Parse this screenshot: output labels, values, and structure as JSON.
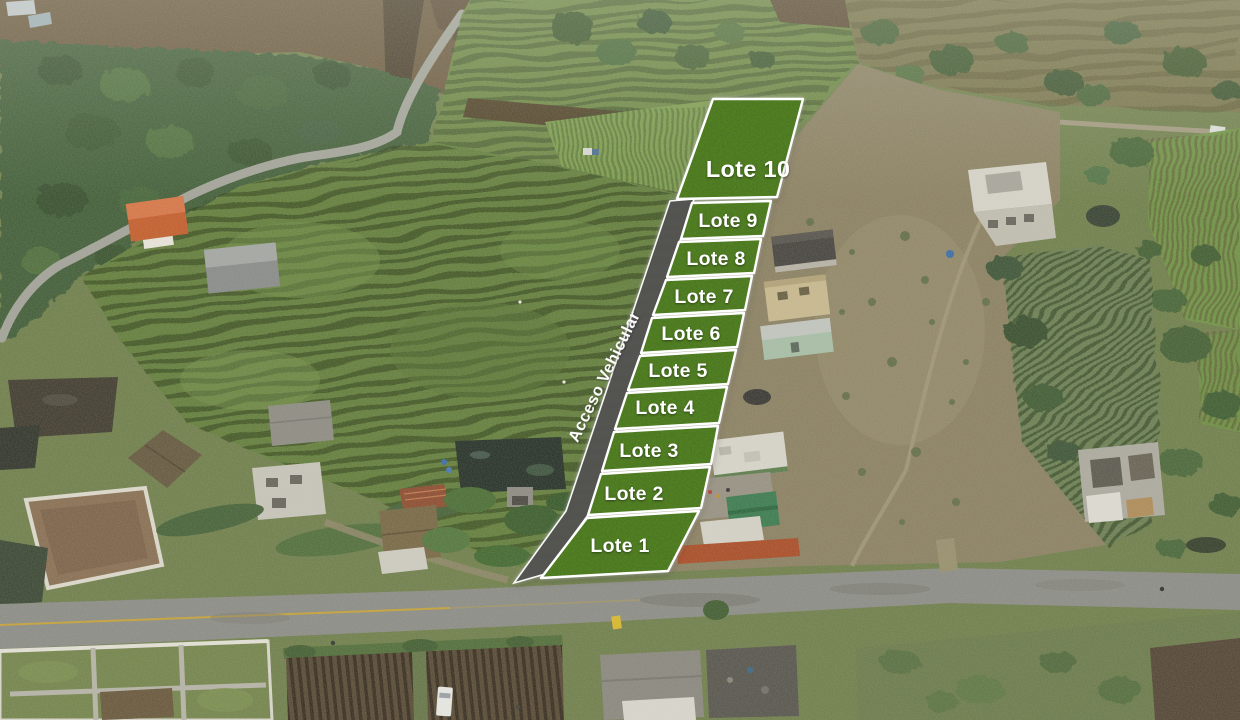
{
  "overlay": {
    "access_road_label": "Acceso Vehicular",
    "lots": [
      {
        "label": "Lote 1"
      },
      {
        "label": "Lote 2"
      },
      {
        "label": "Lote 3"
      },
      {
        "label": "Lote 4"
      },
      {
        "label": "Lote 5"
      },
      {
        "label": "Lote 6"
      },
      {
        "label": "Lote 7"
      },
      {
        "label": "Lote 8"
      },
      {
        "label": "Lote 9"
      },
      {
        "label": "Lote 10"
      }
    ],
    "colors": {
      "lot_fill": "#53861e",
      "lot_border": "#ffffff",
      "road_fill": "#4e4e4b",
      "label_text": "#ffffff"
    }
  }
}
